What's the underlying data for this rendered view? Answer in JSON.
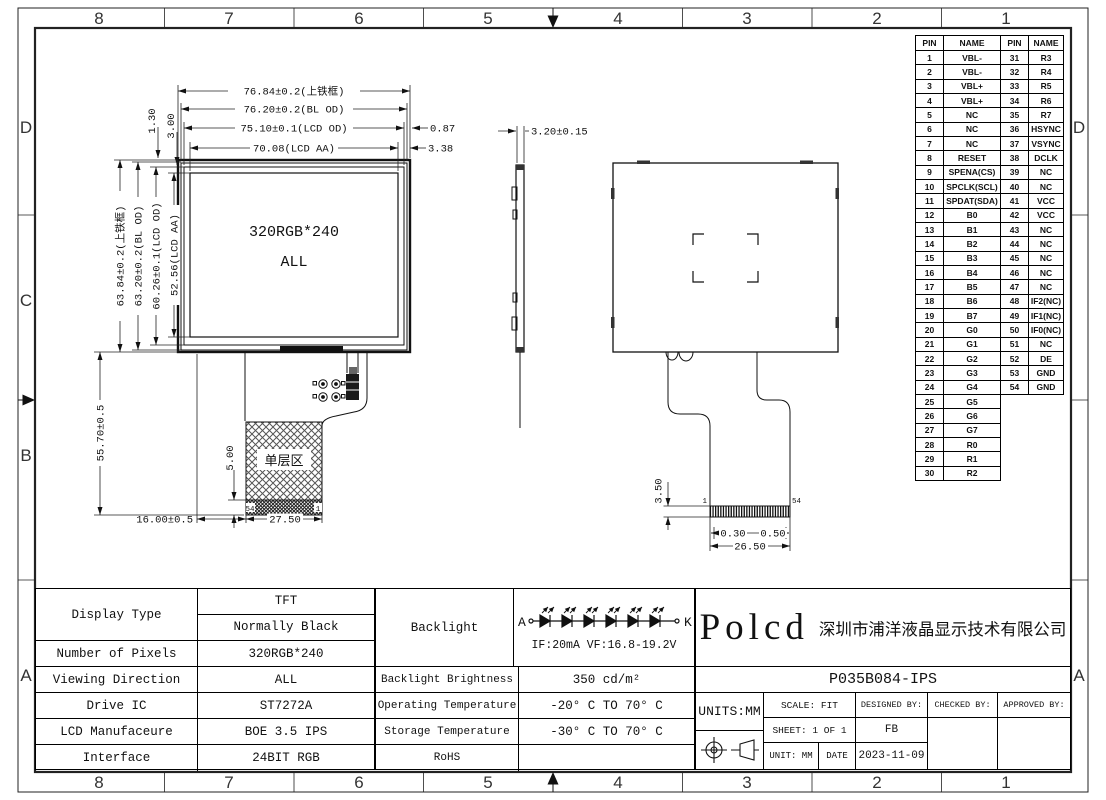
{
  "border": {
    "cols": [
      "8",
      "7",
      "6",
      "5",
      "4",
      "3",
      "2",
      "1"
    ],
    "rows_left": [
      "D",
      "C",
      "B",
      "A"
    ],
    "rows_right": [
      "D",
      "A"
    ]
  },
  "front_view": {
    "label_line1": "320RGB*240",
    "label_line2": "ALL",
    "area_label": "单层区",
    "dims": {
      "d_top1": "76.84±0.2(上铁框)",
      "d_top2": "76.20±0.2(BL OD)",
      "d_top3": "75.10±0.1(LCD OD)",
      "d_top4": "70.08(LCD AA)",
      "d_right1": "0.87",
      "d_right2": "3.38",
      "d_small1": "1.30",
      "d_small2": "3.00",
      "d_left1": "63.84±0.2(上铁框)",
      "d_left2": "63.20±0.2(BL OD)",
      "d_left3": "60.26±0.1(LCD OD)",
      "d_left4": "52.56(LCD AA)",
      "d_left5": "55.70±0.5",
      "d_bottom1": "16.00±0.5",
      "d_bottom2": "27.50",
      "d_tail": "5.00",
      "pin54": "54",
      "pin1": "1"
    }
  },
  "side_view": {
    "dim": "3.20±0.15"
  },
  "rear_view": {
    "dims": {
      "d1": "3.50",
      "d2": "0.30",
      "d3": "0.50",
      "d4": "26.50",
      "pin1": "1",
      "pin54": "54"
    }
  },
  "pin_table": {
    "headers": [
      "PIN",
      "NAME",
      "PIN",
      "NAME"
    ],
    "left": [
      {
        "pin": "1",
        "name": "VBL-"
      },
      {
        "pin": "2",
        "name": "VBL-"
      },
      {
        "pin": "3",
        "name": "VBL+"
      },
      {
        "pin": "4",
        "name": "VBL+"
      },
      {
        "pin": "5",
        "name": "NC"
      },
      {
        "pin": "6",
        "name": "NC"
      },
      {
        "pin": "7",
        "name": "NC"
      },
      {
        "pin": "8",
        "name": "RESET"
      },
      {
        "pin": "9",
        "name": "SPENA(CS)"
      },
      {
        "pin": "10",
        "name": "SPCLK(SCL)"
      },
      {
        "pin": "11",
        "name": "SPDAT(SDA)"
      },
      {
        "pin": "12",
        "name": "B0"
      },
      {
        "pin": "13",
        "name": "B1"
      },
      {
        "pin": "14",
        "name": "B2"
      },
      {
        "pin": "15",
        "name": "B3"
      },
      {
        "pin": "16",
        "name": "B4"
      },
      {
        "pin": "17",
        "name": "B5"
      },
      {
        "pin": "18",
        "name": "B6"
      },
      {
        "pin": "19",
        "name": "B7"
      },
      {
        "pin": "20",
        "name": "G0"
      },
      {
        "pin": "21",
        "name": "G1"
      },
      {
        "pin": "22",
        "name": "G2"
      },
      {
        "pin": "23",
        "name": "G3"
      },
      {
        "pin": "24",
        "name": "G4"
      },
      {
        "pin": "25",
        "name": "G5"
      },
      {
        "pin": "26",
        "name": "G6"
      },
      {
        "pin": "27",
        "name": "G7"
      },
      {
        "pin": "28",
        "name": "R0"
      },
      {
        "pin": "29",
        "name": "R1"
      },
      {
        "pin": "30",
        "name": "R2"
      }
    ],
    "right": [
      {
        "pin": "31",
        "name": "R3"
      },
      {
        "pin": "32",
        "name": "R4"
      },
      {
        "pin": "33",
        "name": "R5"
      },
      {
        "pin": "34",
        "name": "R6"
      },
      {
        "pin": "35",
        "name": "R7"
      },
      {
        "pin": "36",
        "name": "HSYNC"
      },
      {
        "pin": "37",
        "name": "VSYNC"
      },
      {
        "pin": "38",
        "name": "DCLK"
      },
      {
        "pin": "39",
        "name": "NC"
      },
      {
        "pin": "40",
        "name": "NC"
      },
      {
        "pin": "41",
        "name": "VCC"
      },
      {
        "pin": "42",
        "name": "VCC"
      },
      {
        "pin": "43",
        "name": "NC"
      },
      {
        "pin": "44",
        "name": "NC"
      },
      {
        "pin": "45",
        "name": "NC"
      },
      {
        "pin": "46",
        "name": "NC"
      },
      {
        "pin": "47",
        "name": "NC"
      },
      {
        "pin": "48",
        "name": "IF2(NC)"
      },
      {
        "pin": "49",
        "name": "IF1(NC)"
      },
      {
        "pin": "50",
        "name": "IF0(NC)"
      },
      {
        "pin": "51",
        "name": "NC"
      },
      {
        "pin": "52",
        "name": "DE"
      },
      {
        "pin": "53",
        "name": "GND"
      },
      {
        "pin": "54",
        "name": "GND"
      }
    ]
  },
  "spec_table": {
    "left": {
      "display_type_label": "Display Type",
      "display_type_v1": "TFT",
      "display_type_v2": "Normally Black",
      "rows": [
        {
          "label": "Number of Pixels",
          "value": "320RGB*240"
        },
        {
          "label": "Viewing Direction",
          "value": "ALL"
        },
        {
          "label": "Drive IC",
          "value": "ST7272A"
        },
        {
          "label": "LCD Manufaceure",
          "value": "BOE 3.5 IPS"
        },
        {
          "label": "Interface",
          "value": "24BIT RGB"
        }
      ]
    },
    "middle": {
      "backlight_label": "Backlight",
      "rows": [
        {
          "label": "Backlight Brightness",
          "value": "350 cd/m²"
        },
        {
          "label": "Operating Temperature",
          "value": "-20° C TO 70° C"
        },
        {
          "label": "Storage Temperature",
          "value": "-30° C TO 70° C"
        },
        {
          "label": "RoHS",
          "value": ""
        }
      ]
    }
  },
  "backlight": {
    "anode": "A",
    "cathode": "K",
    "spec": "IF:20mA  VF:16.8-19.2V"
  },
  "title_block": {
    "logo": "Polcd",
    "company": "深圳市浦洋液晶显示技术有限公司",
    "part_number": "P035B084-IPS",
    "units": "UNITS:MM",
    "scale": "SCALE: FIT",
    "designed_by": "DESIGNED BY:",
    "checked_by": "CHECKED BY:",
    "approved_by": "APPROVED BY:",
    "sheet": "SHEET: 1 OF 1",
    "designer": "FB",
    "unit": "UNIT: MM",
    "date_label": "DATE",
    "date": "2023-11-09"
  }
}
